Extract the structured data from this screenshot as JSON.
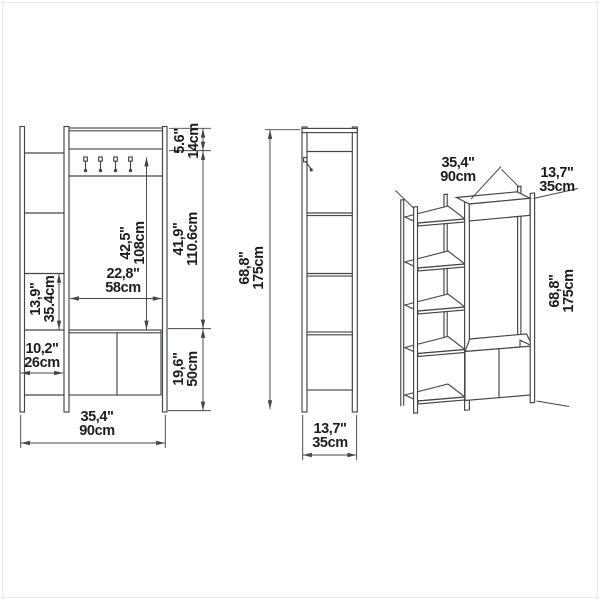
{
  "page": {
    "title": "Hallway unit technical dimension drawing",
    "background_color": "#ffffff",
    "line_color": "#41464b",
    "text_color": "#1a1d20",
    "border_color": "#e9e9e9"
  },
  "views": {
    "front": {
      "name": "front elevation",
      "hook_count": 4,
      "dimensions": {
        "top_panel_height": {
          "inch": "5.6\"",
          "cm": "14cm"
        },
        "open_zone_height": {
          "inch": "41,9\"",
          "cm": "110.6cm"
        },
        "cabinet_zone_height": {
          "inch": "19,6\"",
          "cm": "50cm"
        },
        "hook_to_cabinet": {
          "inch": "42,5\"",
          "cm": "108cm"
        },
        "inner_width": {
          "inch": "22,8\"",
          "cm": "58cm"
        },
        "shelf_gap": {
          "inch": "13,9\"",
          "cm": "35.4cm"
        },
        "shelf_column_width": {
          "inch": "10,2\"",
          "cm": "26cm"
        },
        "total_width": {
          "inch": "35,4\"",
          "cm": "90cm"
        }
      }
    },
    "side": {
      "name": "side elevation",
      "dimensions": {
        "total_height": {
          "inch": "68,8\"",
          "cm": "175cm"
        },
        "total_depth": {
          "inch": "13,7\"",
          "cm": "35cm"
        }
      }
    },
    "perspective": {
      "name": "3d view",
      "dimensions": {
        "total_width": {
          "inch": "35,4\"",
          "cm": "90cm"
        },
        "total_depth": {
          "inch": "13,7\"",
          "cm": "35cm"
        },
        "total_height": {
          "inch": "68,8\"",
          "cm": "175cm"
        }
      }
    }
  }
}
